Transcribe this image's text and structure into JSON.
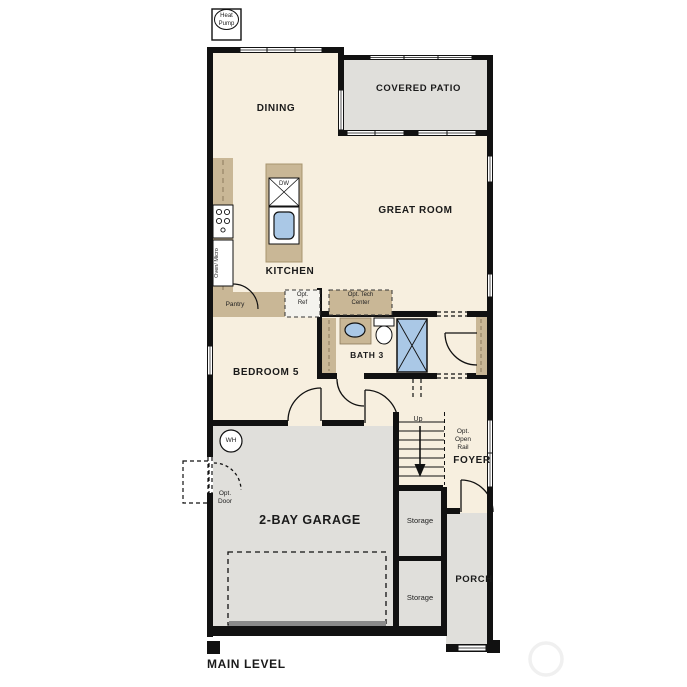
{
  "title": "MAIN LEVEL",
  "colors": {
    "room_fill": "#f7efdf",
    "outdoor_fill": "#e0dfdb",
    "counter_fill": "#c9b796",
    "fixture_blue": "#aac8e6",
    "wall": "#111111",
    "garage_door_band": "#8a8a8a"
  },
  "rooms": {
    "dining": "DINING",
    "covered_patio": "COVERED PATIO",
    "great_room": "GREAT ROOM",
    "kitchen": "KITCHEN",
    "bedroom5": "BEDROOM 5",
    "bath3": "BATH 3",
    "foyer": "FOYER",
    "garage": "2-BAY GARAGE",
    "porch": "PORCH",
    "storage_upper": "Storage",
    "storage_lower": "Storage"
  },
  "annotations": {
    "heat_pump": "Heat Pump",
    "water_heater": "WH",
    "dishwasher": "DW",
    "oven_micro": "Oven/ Micro",
    "pantry": "Pantry",
    "opt_ref": "Opt. Ref",
    "opt_tech_center": "Opt. Tech Center",
    "opt_door": "Opt. Door",
    "up": "Up",
    "opt_open_rail": "Opt. Open Rail",
    "main_level": "MAIN LEVEL"
  }
}
